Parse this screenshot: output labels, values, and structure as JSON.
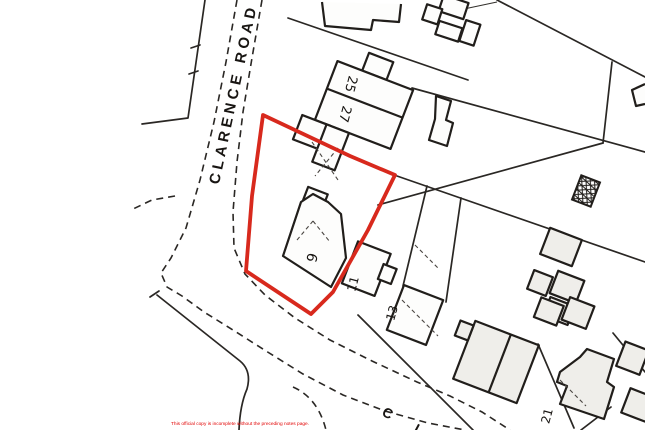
{
  "map": {
    "road_labels": {
      "clarence_road": "CLARENCE ROAD",
      "partial_road": "C L"
    },
    "house_numbers": {
      "n25": "25",
      "n27": "27",
      "n9": "9",
      "n11": "11",
      "n13": "13",
      "n21": "21"
    },
    "colors": {
      "boundary_red": "#d8291d",
      "line_black": "#211e1b",
      "background": "#ffffff",
      "disclaimer_red": "#e20202"
    },
    "disclaimer": "This official copy is incomplete without the preceding notes page."
  }
}
